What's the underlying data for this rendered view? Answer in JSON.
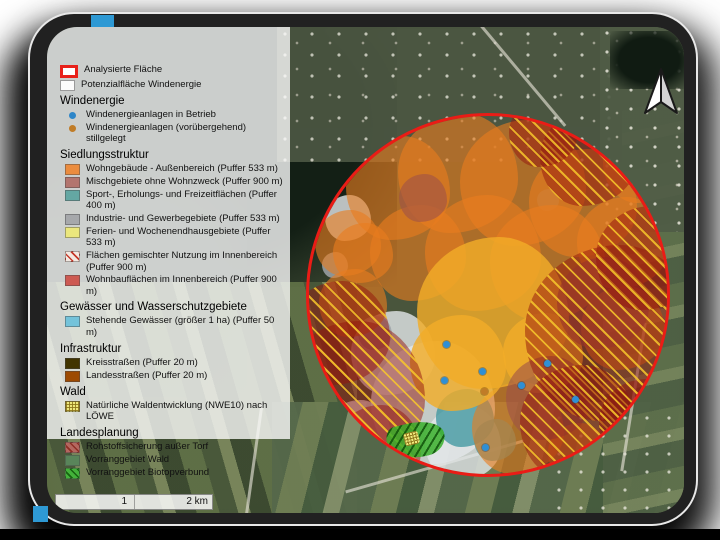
{
  "legend": {
    "top_items": [
      {
        "label": "Analysierte Fläche",
        "swatch": "analyzed-area",
        "name": "legend-analyzed-area"
      },
      {
        "label": "Potenzialfläche Windenergie",
        "swatch": "potential-area",
        "name": "legend-potential-area"
      }
    ],
    "sections": [
      {
        "title": "Windenergie",
        "items": [
          {
            "label": "Windenergieanlagen in Betrieb",
            "swatch": "dot-blue",
            "name": "legend-turbine-active"
          },
          {
            "label": "Windenergieanlagen (vorübergehend) stillgelegt",
            "swatch": "dot-orange",
            "name": "legend-turbine-idle"
          }
        ]
      },
      {
        "title": "Siedlungsstruktur",
        "items": [
          {
            "label": "Wohngebäude - Außenbereich (Puffer 533 m)",
            "swatch": "residential-outer",
            "name": "legend-residential-outer"
          },
          {
            "label": "Mischgebiete ohne Wohnzweck (Puffer 900 m)",
            "swatch": "mixed-no-residential",
            "name": "legend-mixed-no-residential"
          },
          {
            "label": "Sport-, Erholungs- und Freizeitflächen (Puffer 400 m)",
            "swatch": "sport-leisure",
            "name": "legend-sport-leisure"
          },
          {
            "label": "Industrie- und Gewerbegebiete (Puffer 533 m)",
            "swatch": "industry",
            "name": "legend-industry"
          },
          {
            "label": "Ferien- und Wochenendhausgebiete (Puffer 533 m)",
            "swatch": "holiday-homes",
            "name": "legend-holiday-homes"
          },
          {
            "label": "Flächen gemischter Nutzung im Innenbereich (Puffer 900 m)",
            "swatch": "mixed-use-inner",
            "name": "legend-mixed-use-inner"
          },
          {
            "label": "Wohnbauflächen im Innenbereich (Puffer 900 m)",
            "swatch": "residential-inner",
            "name": "legend-residential-inner"
          }
        ]
      },
      {
        "title": "Gewässer und Wasserschutzgebiete",
        "items": [
          {
            "label": "Stehende Gewässer (größer 1 ha) (Puffer 50 m)",
            "swatch": "standing-water",
            "name": "legend-standing-water"
          }
        ]
      },
      {
        "title": "Infrastruktur",
        "items": [
          {
            "label": "Kreisstraßen (Puffer 20 m)",
            "swatch": "county-roads",
            "name": "legend-county-roads"
          },
          {
            "label": "Landesstraßen (Puffer 20 m)",
            "swatch": "state-roads",
            "name": "legend-state-roads"
          }
        ]
      },
      {
        "title": "Wald",
        "items": [
          {
            "label": "Natürliche Waldentwicklung (NWE10) nach LÖWE",
            "swatch": "natural-forest",
            "name": "legend-natural-forest"
          }
        ]
      },
      {
        "title": "Landesplanung",
        "items": [
          {
            "label": "Rohstoffsicherung außer Torf",
            "swatch": "raw-materials",
            "name": "legend-raw-materials"
          },
          {
            "label": "Vorranggebiet Wald",
            "swatch": "priority-forest",
            "name": "legend-priority-forest"
          },
          {
            "label": "Vorranggebiet Biotopverbund",
            "swatch": "priority-biotope",
            "name": "legend-priority-biotope"
          }
        ]
      }
    ]
  },
  "map": {
    "scalebar": {
      "mid_label": "1",
      "end_label": "2 km"
    }
  },
  "colors": {
    "analyzed_outline": "#ea1c16",
    "turbine_active": "#2e86c8",
    "turbine_idle": "#c07c27",
    "buffer_orange": "#eb8c3e",
    "potential_fill": "#e3e7ea"
  }
}
